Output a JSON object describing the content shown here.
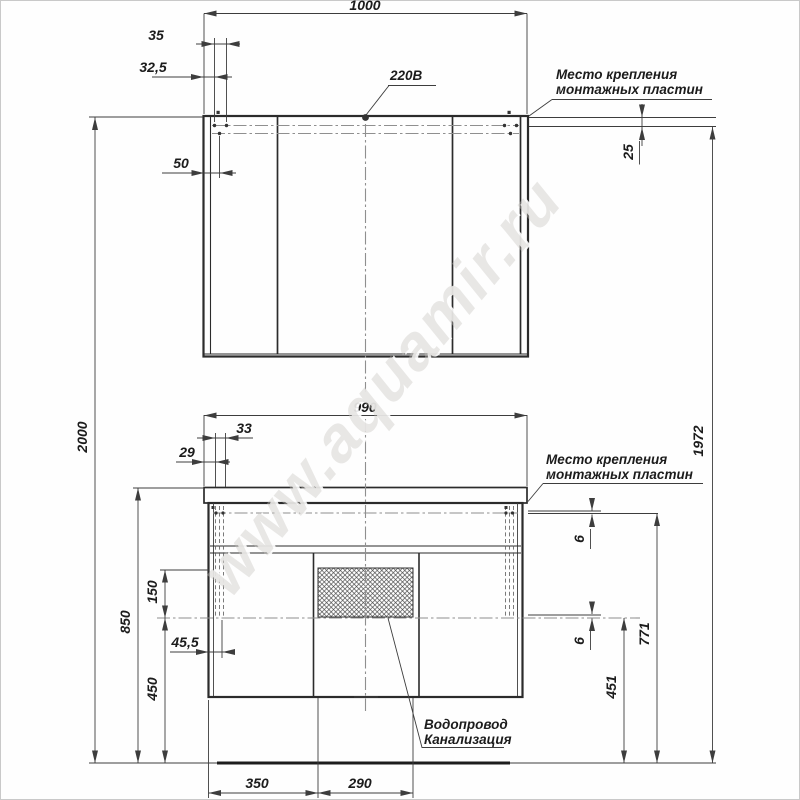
{
  "drawing": {
    "watermark": "www.aquamir.ru",
    "callouts": {
      "power": "220В",
      "mount_top": [
        "Место крепления",
        "монтажных пластин"
      ],
      "mount_bottom": [
        "Место крепления",
        "монтажных пластин"
      ],
      "plumbing": [
        "Водопровод",
        "Канализация"
      ]
    },
    "dims": {
      "mirror_width": "1000",
      "mirror_hole_spacing": "35",
      "mirror_hole_offset": "32,5",
      "mirror_hole_side": "50",
      "mirror_plate_offset": "25",
      "overall_height": "2000",
      "mount_height_right": "1972",
      "vanity_width": "990",
      "vanity_hole_spacing": "33",
      "vanity_hole_offset": "29",
      "opening_height": "150",
      "vanity_hole_side": "45,5",
      "vanity_top_height": "850",
      "vanity_bottom_height": "450",
      "plate_gap_top": "6",
      "plate_gap_bottom": "6",
      "opening_bottom_height": "451",
      "plate_line_height": "771",
      "door_width": "350",
      "opening_width": "290"
    }
  }
}
